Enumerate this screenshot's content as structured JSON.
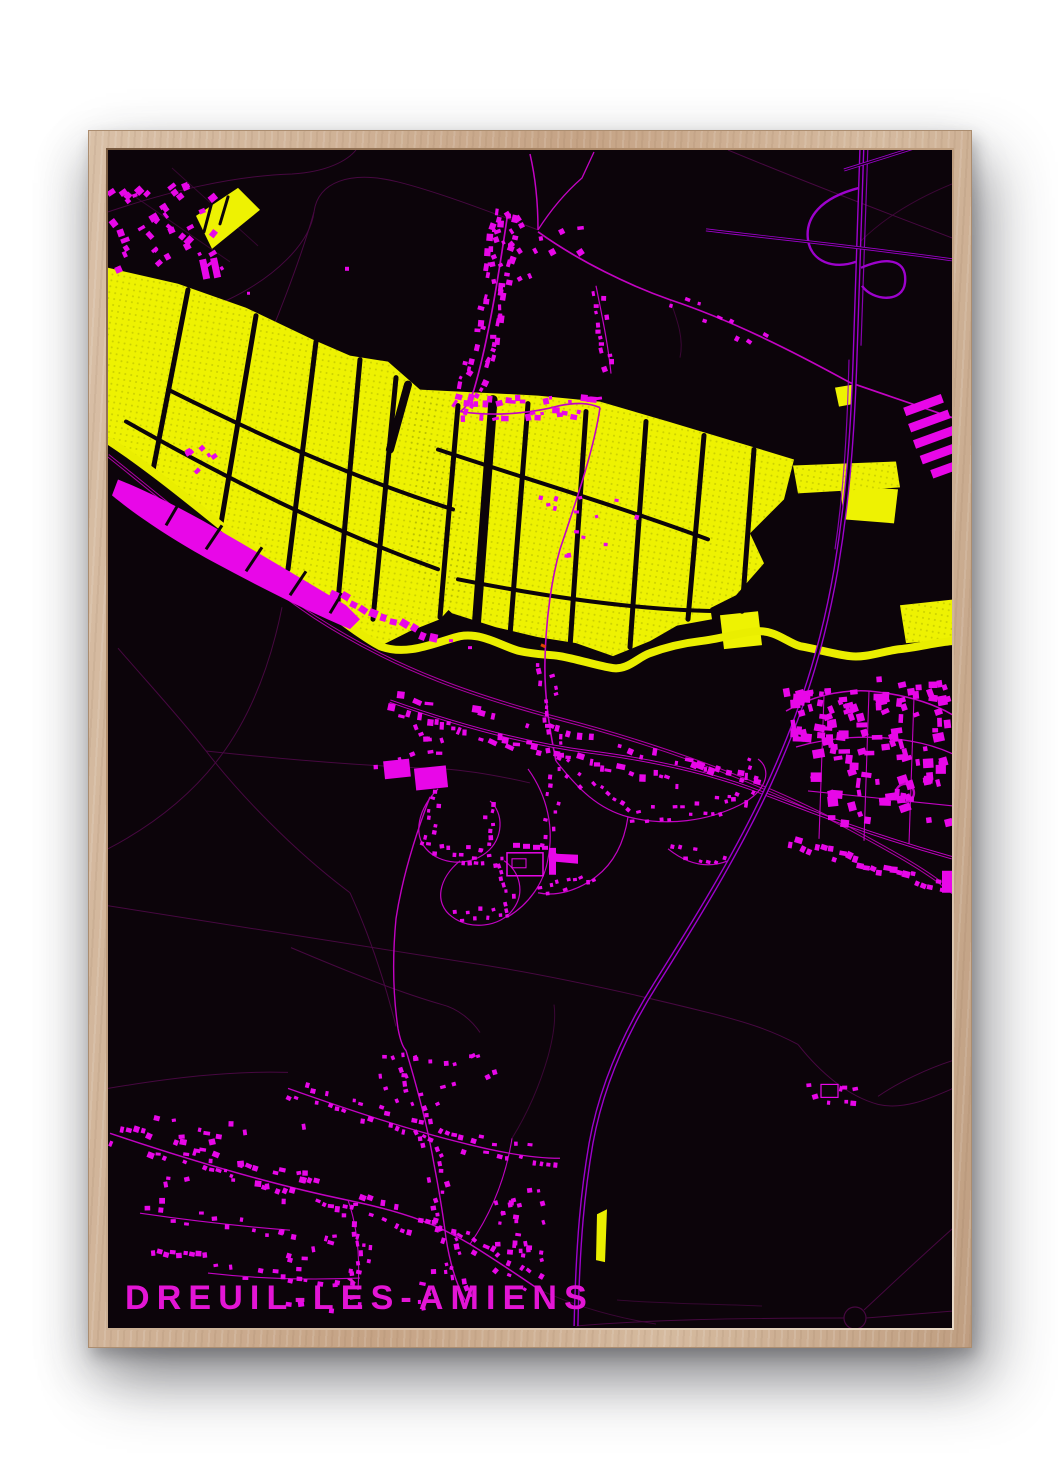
{
  "poster": {
    "title": "DREUIL-LÈS-AMIENS"
  },
  "colors": {
    "page_background": "#ffffff",
    "poster_background": "#0c040a",
    "marsh_yellow": "#eef202",
    "river_yellow": "#eaee00",
    "building_magenta": "#e807e8",
    "road_magenta": "#c203c2",
    "railway_magenta": "#ad02a4",
    "motorway_purple": "#9d02cc",
    "faint_road": "#470841",
    "title_color": "#e315d5",
    "frame_wood": "#c5a385",
    "frame_wood_light": "#e9d9c6",
    "frame_wood_dark": "#77593f"
  }
}
